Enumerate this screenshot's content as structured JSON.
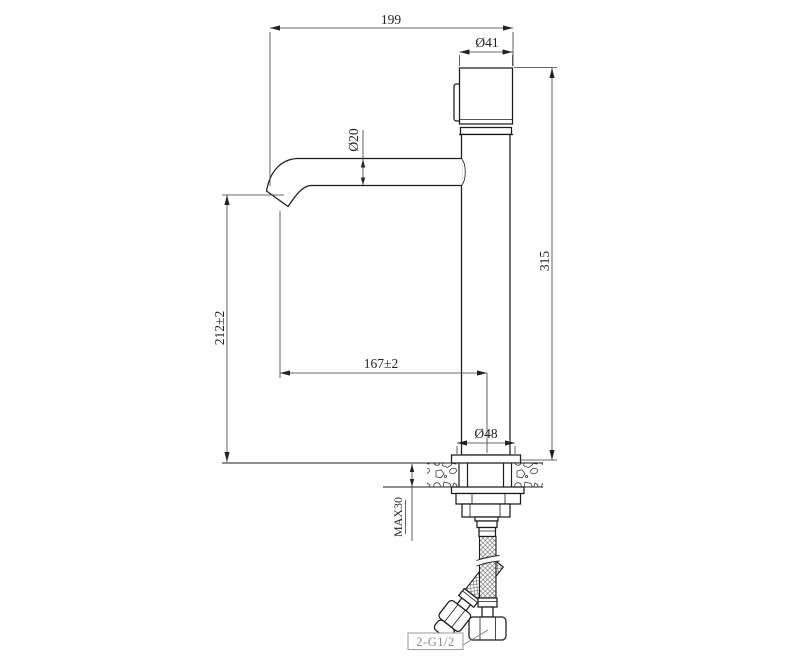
{
  "drawing": {
    "title": "faucet-dimension-drawing",
    "dims": {
      "overall_width": "199",
      "handle_diameter": "Ø41",
      "spout_diameter": "Ø20",
      "overall_height": "315",
      "spout_height": "212±2",
      "spout_reach": "167±2",
      "base_diameter": "Ø48",
      "max_deck_thickness": "MAX30",
      "thread_spec": "2-G1/2"
    },
    "colors": {
      "object_line": "#1c1c1c",
      "dimension_line": "#3a3a3a",
      "label_gray": "#8a8a8a",
      "background": "#ffffff"
    }
  }
}
